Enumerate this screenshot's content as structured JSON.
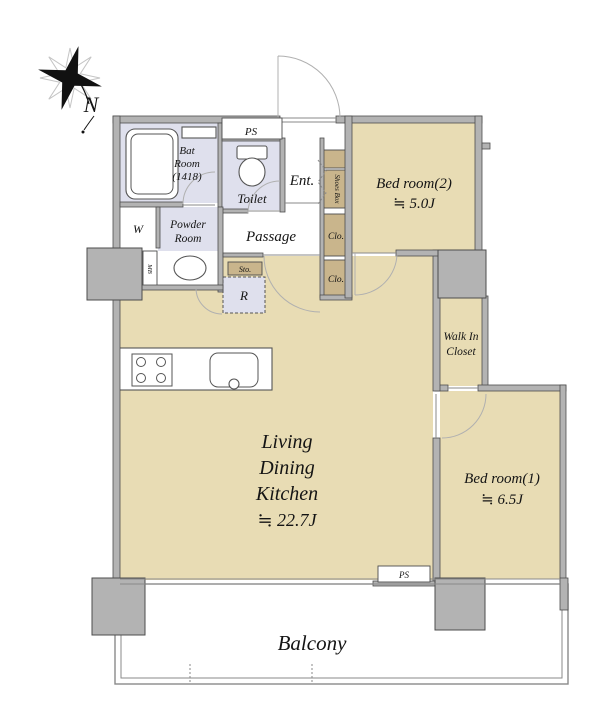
{
  "title": "Apartment floor plan",
  "compass": {
    "label": "N"
  },
  "colors": {
    "floor_tan": "#e8dcb4",
    "closet_tan": "#c9b58c",
    "wet_lavender": "#dfe0ed",
    "wall_gray": "#b3b3b3",
    "wall_outline": "#4d4d4d",
    "text": "#141414",
    "background": "#ffffff"
  },
  "rooms": {
    "bath": {
      "line1": "Bat",
      "line2": "Room",
      "line3": "(1418)"
    },
    "ps_top": {
      "label": "PS"
    },
    "toilet": {
      "label": "Toilet"
    },
    "entrance": {
      "label": "Ent."
    },
    "shoes_box": {
      "label": "Shoes Box"
    },
    "washer": {
      "label": "W"
    },
    "powder_room": {
      "line1": "Powder",
      "line2": "Room"
    },
    "meter_box": {
      "label": "MB"
    },
    "passage": {
      "label": "Passage"
    },
    "storage": {
      "label": "Sto."
    },
    "refrigerator": {
      "label": "R"
    },
    "closet1": {
      "label": "Clo."
    },
    "closet2": {
      "label": "Clo."
    },
    "bedroom2": {
      "name": "Bed room(2)",
      "size": "≒ 5.0J"
    },
    "walk_in_closet": {
      "line1": "Walk In",
      "line2": "Closet"
    },
    "bedroom1": {
      "name": "Bed room(1)",
      "size": "≒ 6.5J"
    },
    "ldk": {
      "line1": "Living",
      "line2": "Dining",
      "line3": "Kitchen",
      "size": "≒ 22.7J"
    },
    "ps_bottom": {
      "label": "PS"
    },
    "balcony": {
      "label": "Balcony"
    }
  }
}
